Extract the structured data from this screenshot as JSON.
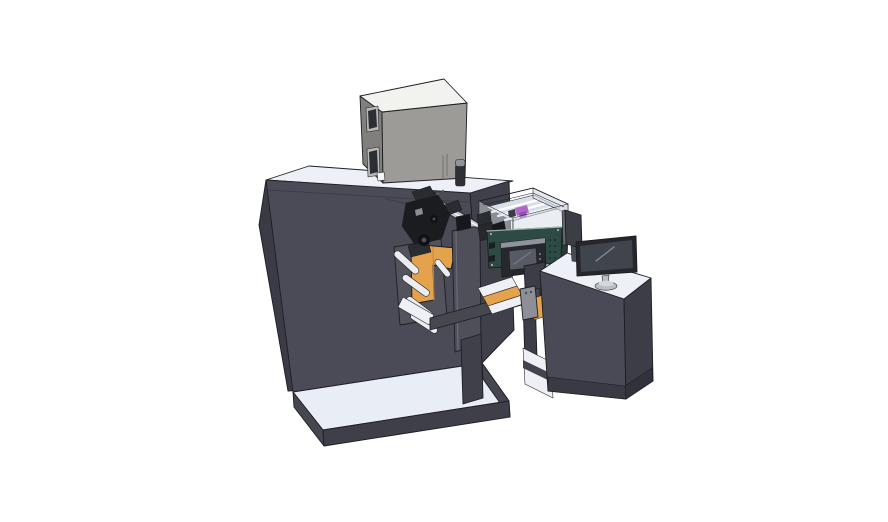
{
  "scene": {
    "background": "#ffffff",
    "width": 888,
    "height": 522
  },
  "palette": {
    "bg": "#ffffff",
    "machineTop": "#edf0f7",
    "machineLeft": "#3a3b44",
    "machineFront": "#4a4b56",
    "machineRight": "#3f4049",
    "seamLine": "#3c3d47",
    "mechDots": "#5a5b63",
    "stepTop": "#e9edf6",
    "stepSide": "#45464f",
    "stepFront": "#3e3f48",
    "cabinetTop": "#f2f2ef",
    "cabinetFront": "#9c9b97",
    "cabinetLeft": "#807f7b",
    "winFrame": "#b9b9b6",
    "winGlass": "#2b2e34",
    "vent": "#73736f",
    "whiteSquare": "#f5f5f3",
    "cylBody": "#2e3036",
    "cylCap": "#90939a",
    "backplate": "#52535d",
    "orange": "#e4a24c",
    "orangeShade": "#c4873a",
    "roller": "#eaedf2",
    "mechDark": "#1b1c20",
    "mechMid": "#2a2c32",
    "mechLight": "#8a8d94",
    "mechBoss": "#0e0f13",
    "bossInner": "#4a4e56",
    "rail": "#c4c8cf",
    "railEnd": "#26282d",
    "plateCover": "#4e4f59",
    "plateCap": "#17181c",
    "plateHi": "#6e707b",
    "encWall": "#d6dce6",
    "encFloor": "#d9dfe8",
    "encRail": "#ffffff",
    "encDark": "#3a3d45",
    "purpleA": "#b168c9",
    "purpleB": "#8f4fae",
    "teal": "#2e4a44",
    "tealSide": "#243b36",
    "tealDark": "#15211e",
    "tealLight": "#9fb3ac",
    "hmiBezel": "#26282e",
    "hmiTop": "#8f939a",
    "hmiScreen": "#565b66",
    "hmiGlint": "#7d828c",
    "beam": "#47484f",
    "column": "#3f4049",
    "legDark": "#3c3d46",
    "rampWhite": "#eef0f5",
    "handle": "#8e8f96",
    "handleDot": "#4a4b50",
    "platWhite": "#eef0f5",
    "platBand": "#43444d",
    "deskTop": "#edf0f7",
    "deskFront": "#494a55",
    "deskRight": "#3c3d47",
    "deskKick1": "#393a43",
    "deskKick2": "#31323b",
    "panelBack": "#3c3e46",
    "panelEdge": "#646670",
    "panelStand": "#4a4c55",
    "monBezel": "#26272d",
    "monScreen": "#40444d",
    "monGlint": "#8b8f98",
    "standGray": "#b9bdc5",
    "standLight": "#d4d7dd"
  }
}
